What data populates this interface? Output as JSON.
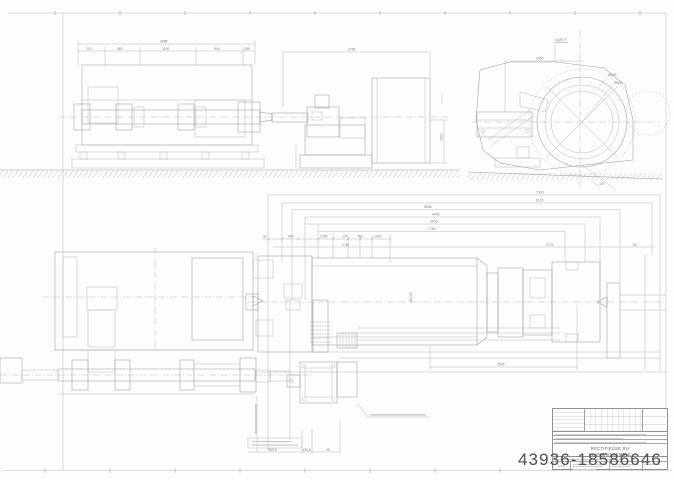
{
  "watermark": {
    "text": "43936-18586646",
    "color": "#4f4f4f"
  },
  "sheet": {
    "paper": "#fdfdfd",
    "line_color": "#9aa0a5",
    "dark_line_color": "#7e858b",
    "hatch_color": "#b3b8bc"
  },
  "top_left_view": {
    "overall_dim": "3085",
    "sub_dims": [
      "212",
      "560",
      "1100",
      "944",
      "269"
    ],
    "right_overall_dim": "2785",
    "height_dim": "1500"
  },
  "end_view": {
    "label": "VUE F",
    "width_dim": "1850",
    "diameter_labels": [
      "Ø650",
      "Ø500"
    ],
    "angle_label": "25°"
  },
  "dim_stack": {
    "rows": [
      "7300",
      "6120",
      "5935",
      "4445",
      "2935",
      "1753"
    ],
    "segment_row": [
      "42",
      "944",
      "1035",
      "147",
      "760",
      "1014"
    ],
    "bottom": "2761",
    "right_pair": [
      "2741",
      "84"
    ]
  },
  "main_view": {
    "length_dim": "2546",
    "roll_label": "Ø1030"
  },
  "bottom_view": {
    "dims": [
      "900.5",
      "134.5",
      "40"
    ]
  },
  "title_block": {
    "title_line1": "RECTIFIEUSE RU",
    "title_line2": "PLAN D'ENSEMBLE",
    "scale": "1:10"
  }
}
